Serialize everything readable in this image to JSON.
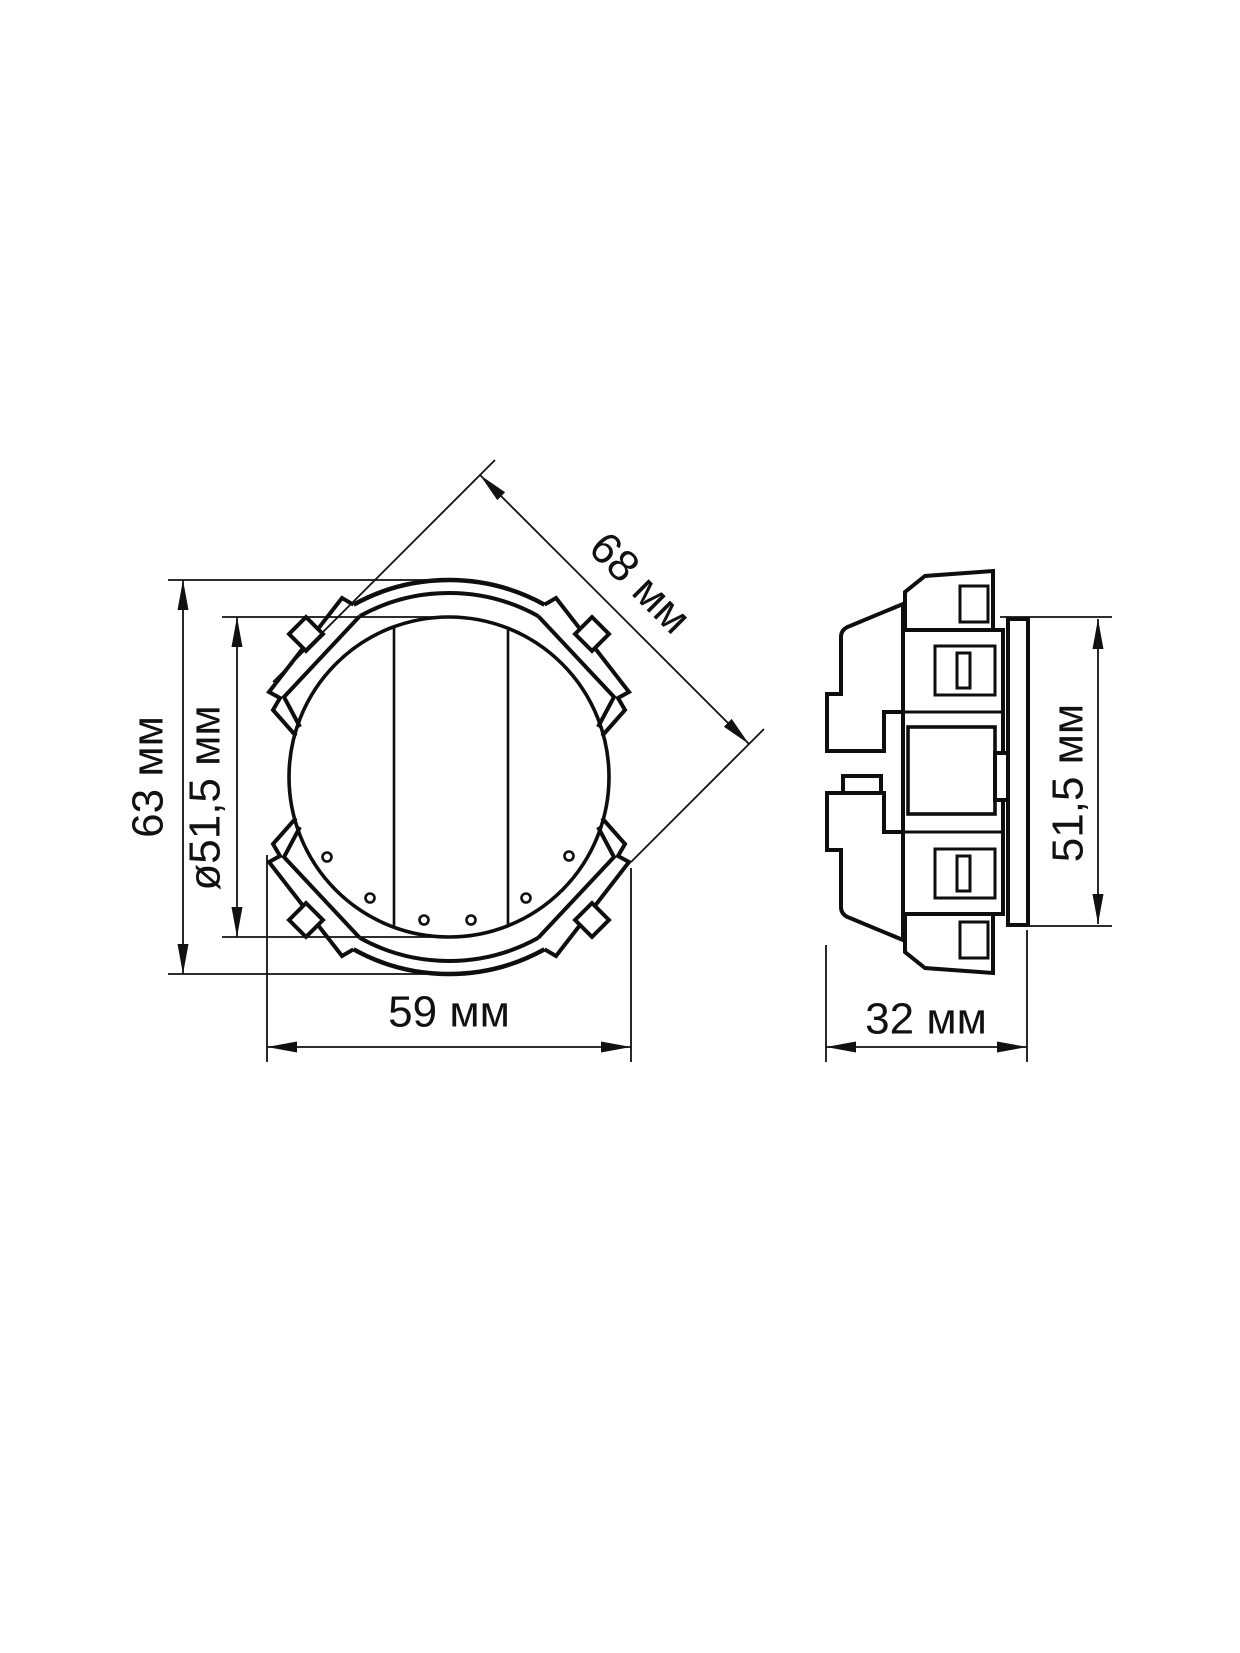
{
  "drawing": {
    "background": "#ffffff",
    "line_color": "#111111",
    "views": {
      "front": {
        "dim_height": "63 мм",
        "dim_inner_diameter": "ø51,5 мм",
        "dim_width": "59 мм",
        "dim_diagonal": "68 мм"
      },
      "side": {
        "dim_height": "51,5 мм",
        "dim_depth": "32 мм"
      }
    }
  }
}
